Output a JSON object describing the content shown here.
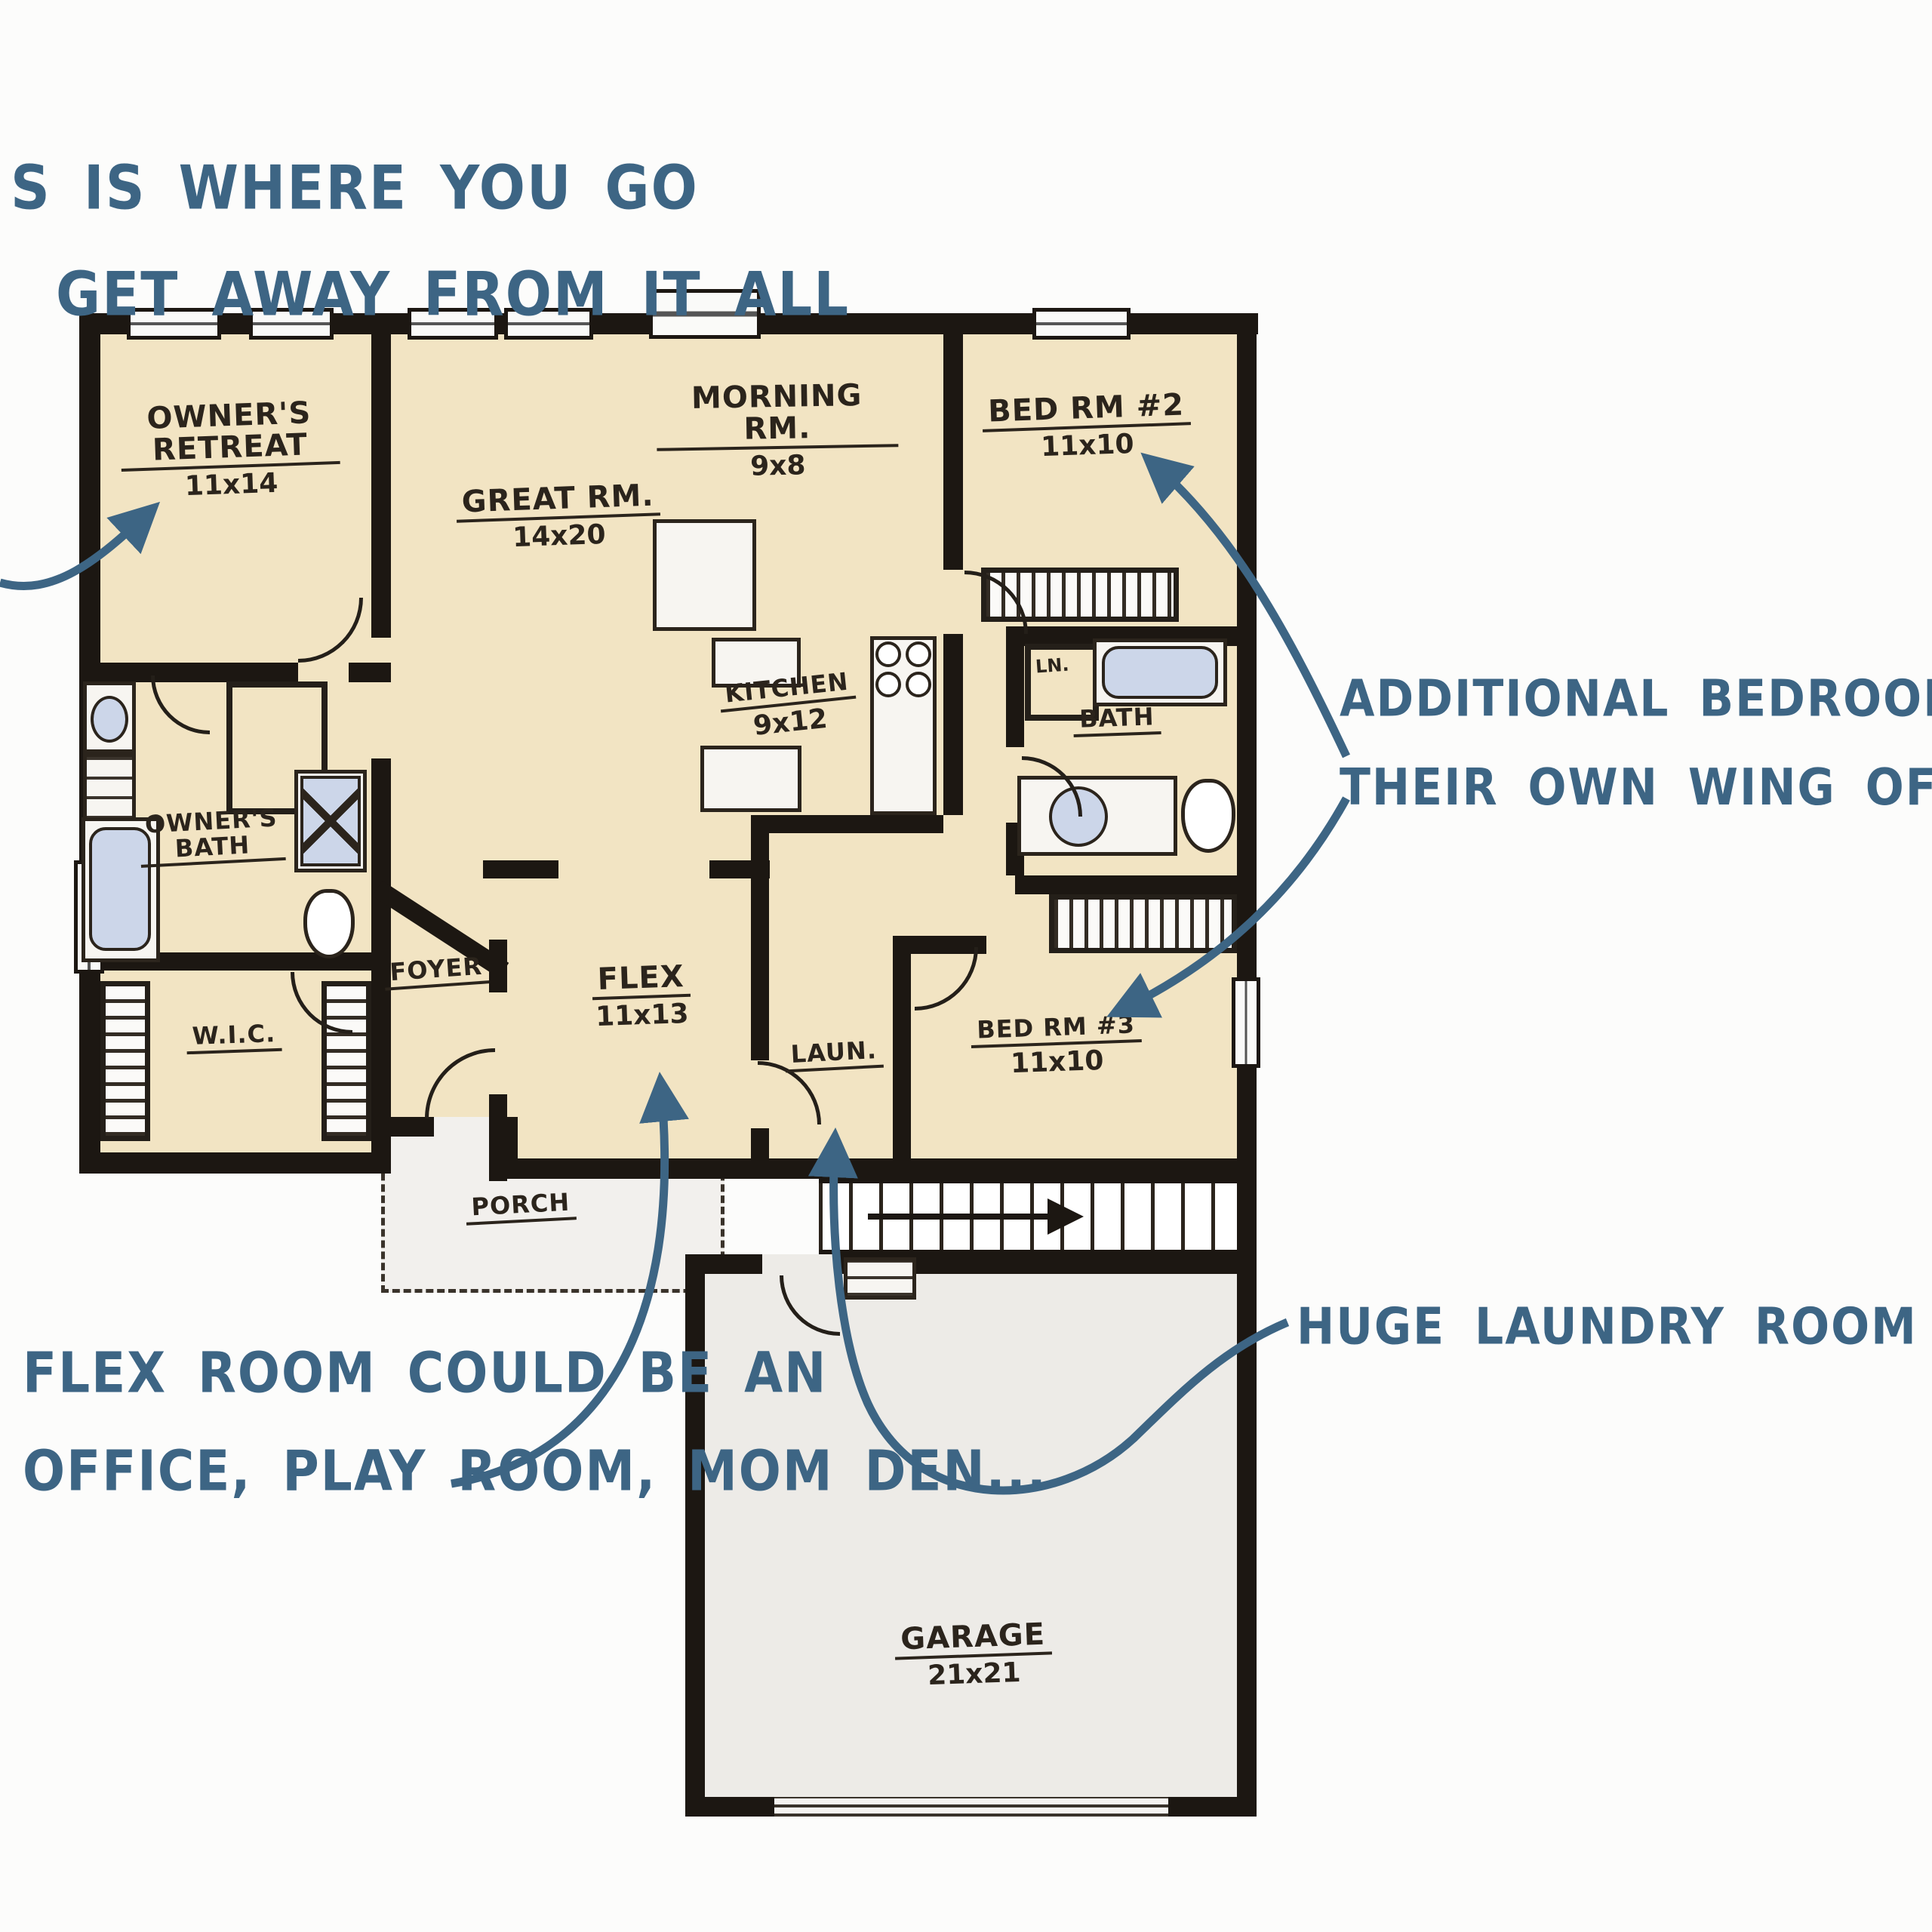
{
  "title": "Ranch floor plan sketch with designer notes",
  "annotations": {
    "retreat": {
      "line1": "S IS WHERE YOU GO",
      "line2": "GET AWAY FROM IT ALL"
    },
    "bedrooms": {
      "line1": "ADDITIONAL BEDROOMS HAVE",
      "line2": "THEIR OWN WING OF THE HOU"
    },
    "flex": {
      "line1": "FLEX ROOM COULD BE AN",
      "line2": "OFFICE, PLAY ROOM, MOM DEN..."
    },
    "laundry": {
      "line1": "HUGE LAUNDRY ROOM"
    }
  },
  "rooms": [
    {
      "name": "OWNER'S RETREAT",
      "dim": "11x14"
    },
    {
      "name": "GREAT RM.",
      "dim": "14x20"
    },
    {
      "name": "MORNING RM.",
      "dim": "9x8"
    },
    {
      "name": "BED RM #2",
      "dim": "11x10"
    },
    {
      "name": "KITCHEN",
      "dim": "9x12"
    },
    {
      "name": "BATH",
      "dim": ""
    },
    {
      "name": "OWNER'S BATH",
      "dim": ""
    },
    {
      "name": "W.I.C.",
      "dim": ""
    },
    {
      "name": "FOYER",
      "dim": ""
    },
    {
      "name": "FLEX",
      "dim": "11x13"
    },
    {
      "name": "LAUN.",
      "dim": ""
    },
    {
      "name": "BED RM #3",
      "dim": "11x10"
    },
    {
      "name": "PORCH",
      "dim": ""
    },
    {
      "name": "GARAGE",
      "dim": "21x21"
    },
    {
      "name": "LN.",
      "dim": ""
    }
  ],
  "colors": {
    "floor_beige": "#f2e4c3",
    "porch_floor": "#f2f0ed",
    "garage_floor": "#edebe7",
    "wall_ink": "#1c1712",
    "label_ink": "#2b241c",
    "annotation_blue": "#3d6584",
    "fixture_blue": "#ccd6e9"
  }
}
